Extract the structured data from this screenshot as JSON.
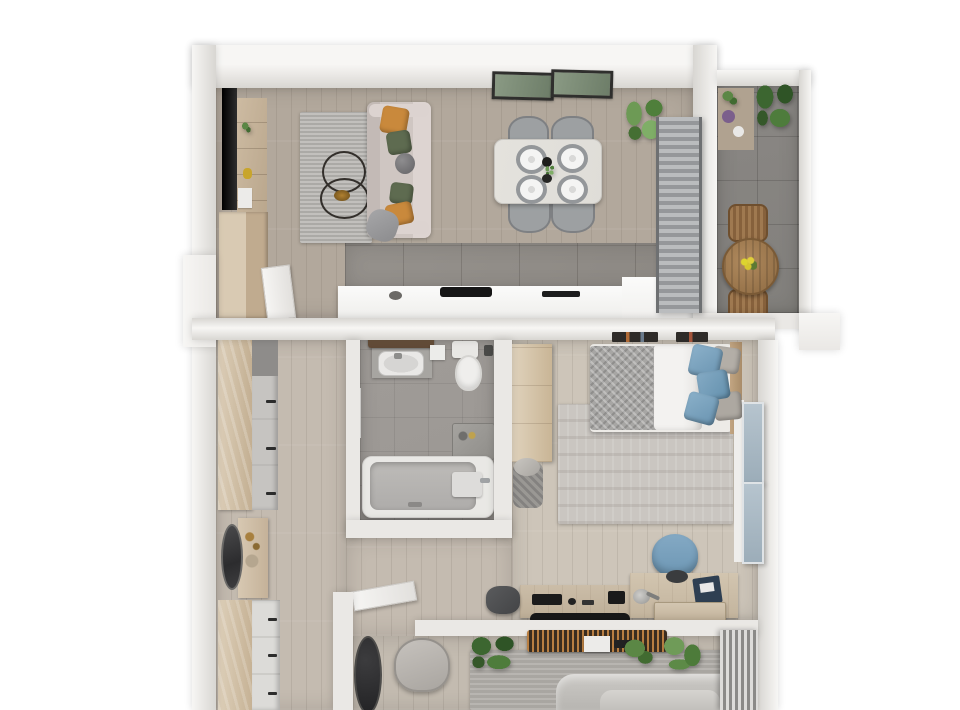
{
  "scene": {
    "type": "3d-floor-plan-top-view",
    "description": "Top-down 3D architectural rendering of a one-bedroom apartment with balcony",
    "rooms": [
      {
        "name": "living-dining-kitchen",
        "floor": "light oak planks with grey tile kitchen strip",
        "furniture": [
          "wall-mounted-tv",
          "media-shelf-unit",
          "tall-kitchen-cabinets",
          "grey-textured-rug",
          "two-round-wire-coffee-tables",
          "sofa-with-orange-and-green-pillows",
          "grey-throw-blanket",
          "dining-table-with-four-grey-chairs",
          "four-place-settings",
          "centerpiece-bottle-and-plant",
          "two-framed-wall-pictures",
          "monstera-potted-plant",
          "grey-curtain-panel",
          "white-kitchen-counter-with-hob-and-sink"
        ]
      },
      {
        "name": "balcony",
        "floor": "dark grey tile",
        "furniture": [
          "plant-shelf-rack",
          "large-green-plant",
          "round-wooden-table-with-yellow-flowers",
          "two-wooden-slat-chairs"
        ]
      },
      {
        "name": "hallway",
        "floor": "light wood planks",
        "furniture": [
          "wardrobe-with-grey-drawer-column",
          "oval-standing-mirror",
          "dressing-console-with-accessories",
          "chest-of-drawers"
        ]
      },
      {
        "name": "bathroom",
        "floor": "grey tile",
        "furniture": [
          "walnut-shelf",
          "vanity-with-white-basin",
          "toilet",
          "wall-accessory",
          "side-stool-with-toiletries",
          "bathtub-with-faucet",
          "towel-rail"
        ]
      },
      {
        "name": "bedroom",
        "floor": "light wood planks",
        "furniture": [
          "wardrobe",
          "laundry-basket",
          "double-bed-with-knit-blanket-and-blue-pillows",
          "wood-headboard",
          "wall-shelf-with-books",
          "patterned-area-rug",
          "floor-to-ceiling-window-with-blue-glass-panels",
          "blue-office-chair",
          "desk-with-keyboard-and-accessories",
          "desk-lamp",
          "sideboard-with-blue-box",
          "under-desk-drawer",
          "dark-duffel-bag",
          "black-floor-runner"
        ]
      },
      {
        "name": "second-room",
        "floor": "light wood planks with grey rug",
        "furniture": [
          "dark-oval-floor-mirror",
          "grey-lounge-chair",
          "three-potted-plants",
          "wooden-slat-bench",
          "grey-bedding",
          "striped-curtain"
        ],
        "note": "partially cropped at bottom edge of image"
      }
    ],
    "doors": [
      "open-door-living-to-hallway",
      "open-door-corridor-to-second-room"
    ]
  },
  "palette": {
    "bg": "#ffffff",
    "wall": "#eae8e5",
    "wallLight": "#f7f6f4",
    "wallDark": "#d8d6d2",
    "woodLiving": "#b2a89c",
    "woodHall": "#c4bbb0",
    "woodBedroom": "#cdc5b9",
    "woodFurniture": "#cdbba2",
    "woodDark": "#a5815a",
    "walnut": "#5f4936",
    "tileKitchen": "#95918c",
    "tileBalcony": "#82807c",
    "tileBath": "#9b9793",
    "rugLiving": "#b6b4b0",
    "rugBedroom": "#cac6c1",
    "rugBottom": "#b2afaa",
    "sofa": "#cfc6c2",
    "pillowOrange": "#c9893c",
    "pillowGreen": "#5e6b50",
    "blue": "#7aa2bf",
    "glassBlue": "#a9bec9",
    "chairGrey": "#9da0a2",
    "tableTop": "#dfddd8",
    "plantGreen": "#5b8745",
    "plantDark": "#3f6b35",
    "curtain": "#a6a8aa",
    "black": "#161616",
    "white": "#f3f2f0",
    "metal": "#a0a3a5",
    "mattress": "#edebe7",
    "knit": "#a7a6a4",
    "porcelain": "#efeeec"
  }
}
